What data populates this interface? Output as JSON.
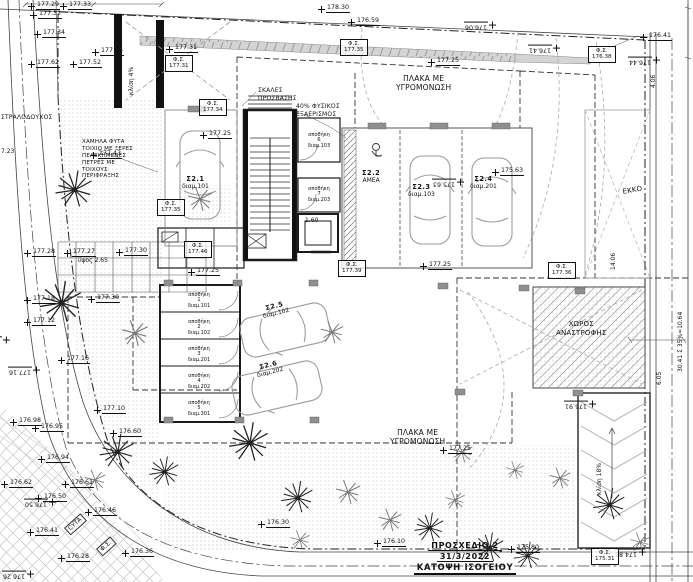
{
  "drawing": {
    "type": "site-plan",
    "colors": {
      "ink": "#111111",
      "road_gray": "#444444",
      "hatch_gray": "#999999",
      "sidewalk_fill": "#d4d4d4",
      "column_fill": "#8f8f8f",
      "paper": "#ffffff"
    }
  },
  "title_block": {
    "line1": "ΠΡΟΣΧΕΔΙΟ 2",
    "line2": "31/3/2022",
    "line3": "ΚΑΤΟΨΗ ΙΣΟΓΕΙΟΥ"
  },
  "symbols": {
    "street_light_label": "Φ.Σ.",
    "benchmark_icon": "survey-cross-icon",
    "tree_icon": "tree-icon",
    "bush_icon": "bush-icon",
    "car_icon": "car-icon",
    "wheelchair_icon": "wheelchair-icon"
  },
  "annotations": [
    {
      "x": 396,
      "y": 74,
      "fs": 7.5,
      "cls": "center",
      "lines": [
        "ΠΛΑΚΑ ΜΕ",
        "ΥΓΡΟΜΟΝΩΣΗ"
      ]
    },
    {
      "x": 390,
      "y": 428,
      "fs": 7.5,
      "cls": "center",
      "lines": [
        "ΠΛΑΚΑ ΜΕ",
        "ΥΓΡΟΜΟΝΩΣΗ"
      ]
    },
    {
      "x": 556,
      "y": 320,
      "fs": 7,
      "cls": "center",
      "lines": [
        "ΧΩΡΟΣ",
        "ΑΝΑΣΤΡΟΦΗΣ"
      ]
    },
    {
      "x": 622,
      "y": 188,
      "fs": 7,
      "rot": -10,
      "lines": [
        "ΕΚΚΟ"
      ]
    },
    {
      "x": 258,
      "y": 87,
      "fs": 6,
      "lines": [
        "ΣΚΑΛΕΣ",
        "ΠΡΟΣΒΑΣΗΣ"
      ]
    },
    {
      "x": 296,
      "y": 103,
      "fs": 6,
      "lines": [
        "40% ΦΥΣΙΚΟΣ",
        "ΕΞΑΕΡΙΣΜΟΣ"
      ]
    },
    {
      "x": 82,
      "y": 139,
      "fs": 5.5,
      "lines": [
        "ΧΑΜΗΛΑ ΦΥΤΑ",
        "ΤΟΙΧΙΟ ΜΕ ΞΕΡΕΣ",
        "ΠΕΛΕΚΗΜΕΝΕΣ",
        "ΠΕΤΡΕΣ ΜΕ",
        "ΤΟΙΧΟΥΣ",
        "ΠΕΡΙΦΡΑΞΗΣ"
      ]
    },
    {
      "x": 1,
      "y": 114,
      "fs": 6,
      "lines": [
        "ΣΤΡΑΛΟΔΟΥΧΟΣ"
      ]
    },
    {
      "x": 64,
      "y": 528,
      "fs": 6,
      "rot": -42,
      "cls": "box",
      "lines": [
        "CYTA"
      ]
    },
    {
      "x": 96,
      "y": 549,
      "fs": 6,
      "rot": -42,
      "cls": "box",
      "lines": [
        "Φ.Σ."
      ]
    }
  ],
  "spot_levels": [
    {
      "v": "177.29",
      "x": 28,
      "y": 2
    },
    {
      "v": "177.33",
      "x": 60,
      "y": 2
    },
    {
      "v": "177.32",
      "x": 30,
      "y": 11
    },
    {
      "v": "177.34",
      "x": 34,
      "y": 30
    },
    {
      "v": "177.62",
      "x": 28,
      "y": 60
    },
    {
      "v": "177.52",
      "x": 70,
      "y": 60
    },
    {
      "v": "177.65",
      "x": 92,
      "y": 48
    },
    {
      "v": "177.31",
      "x": 166,
      "y": 45
    },
    {
      "v": "178.30",
      "x": 318,
      "y": 5
    },
    {
      "v": "176.59",
      "x": 348,
      "y": 18
    },
    {
      "v": "177.25",
      "x": 428,
      "y": 58
    },
    {
      "v": "176.06",
      "x": 496,
      "y": 13,
      "r": 180
    },
    {
      "v": "176.41",
      "x": 560,
      "y": 36,
      "r": 180
    },
    {
      "v": "176.41",
      "x": 640,
      "y": 33
    },
    {
      "v": "176.44",
      "x": 660,
      "y": 48,
      "r": 180
    },
    {
      "v": "177.25",
      "x": 200,
      "y": 131
    },
    {
      "v": "175.63",
      "x": 492,
      "y": 168
    },
    {
      "v": "175.63",
      "x": 464,
      "y": 170,
      "r": 180
    },
    {
      "v": "177.25",
      "x": 420,
      "y": 262
    },
    {
      "v": "177.25",
      "x": 188,
      "y": 268
    },
    {
      "v": "177.28",
      "x": 24,
      "y": 249
    },
    {
      "v": "177.27",
      "x": 64,
      "y": 249
    },
    {
      "v": "177.30",
      "x": 116,
      "y": 248
    },
    {
      "v": "177.18",
      "x": 24,
      "y": 296
    },
    {
      "v": "177.30",
      "x": 88,
      "y": 295
    },
    {
      "v": "177.12",
      "x": 24,
      "y": 318
    },
    {
      "v": "177.00",
      "x": 10,
      "y": 328,
      "r": 182
    },
    {
      "v": "177.16",
      "x": 58,
      "y": 356
    },
    {
      "v": "177.16",
      "x": 40,
      "y": 358,
      "r": 180
    },
    {
      "v": "177.43",
      "x": 90,
      "y": 151
    },
    {
      "v": "176.98",
      "x": 10,
      "y": 418
    },
    {
      "v": "176.95",
      "x": 32,
      "y": 424
    },
    {
      "v": "177.10",
      "x": 94,
      "y": 406
    },
    {
      "v": "176.60",
      "x": 110,
      "y": 429
    },
    {
      "v": "176.94",
      "x": 38,
      "y": 455
    },
    {
      "v": "176.62",
      "x": 1,
      "y": 480
    },
    {
      "v": "176.61",
      "x": 62,
      "y": 480
    },
    {
      "v": "176.50",
      "x": 35,
      "y": 494
    },
    {
      "v": "176.50",
      "x": 56,
      "y": 490,
      "r": 180
    },
    {
      "v": "176.46",
      "x": 85,
      "y": 508
    },
    {
      "v": "176.41",
      "x": 27,
      "y": 528
    },
    {
      "v": "176.28",
      "x": 58,
      "y": 554
    },
    {
      "v": "176.26",
      "x": 34,
      "y": 562,
      "r": 180
    },
    {
      "v": "176.36",
      "x": 122,
      "y": 549
    },
    {
      "v": "176.30",
      "x": 258,
      "y": 520
    },
    {
      "v": "176.10",
      "x": 374,
      "y": 539
    },
    {
      "v": "175.80",
      "x": 508,
      "y": 545
    },
    {
      "v": "177.25",
      "x": 440,
      "y": 446
    },
    {
      "v": "175.91",
      "x": 596,
      "y": 392,
      "r": 180
    },
    {
      "v": "174.85",
      "x": 646,
      "y": 540,
      "r": 180
    }
  ],
  "street_lights": [
    {
      "x": 165,
      "y": 55,
      "v": "177.31"
    },
    {
      "x": 199,
      "y": 99,
      "v": "177.34"
    },
    {
      "x": 340,
      "y": 39,
      "v": "177.35"
    },
    {
      "x": 588,
      "y": 46,
      "v": "176.38"
    },
    {
      "x": 157,
      "y": 199,
      "v": "177.35"
    },
    {
      "x": 184,
      "y": 241,
      "v": "177.46"
    },
    {
      "x": 338,
      "y": 260,
      "v": "177.39"
    },
    {
      "x": 548,
      "y": 262,
      "v": "177.36"
    },
    {
      "x": 591,
      "y": 548,
      "v": "175.31"
    }
  ],
  "dimensions": [
    {
      "v": "4.06",
      "x": 651,
      "y": 88,
      "r": -90
    },
    {
      "v": "14.06",
      "x": 611,
      "y": 270,
      "r": -90
    },
    {
      "v": "6.05",
      "x": 657,
      "y": 385,
      "r": -90
    },
    {
      "v": "30.41 Σ 35%=10.64",
      "x": 678,
      "y": 372,
      "r": -90
    },
    {
      "v": "1.60",
      "x": 305,
      "y": 218
    },
    {
      "v": "ύψος 2.65",
      "x": 78,
      "y": 258
    },
    {
      "v": "κλίση 18%",
      "x": 597,
      "y": 495,
      "r": -90
    },
    {
      "v": "κλίση 4%",
      "x": 129,
      "y": 95,
      "r": -90
    },
    {
      "v": "7.23",
      "x": 1,
      "y": 149
    }
  ],
  "parking_spaces": [
    {
      "code": "Σ2.1",
      "apt": "διαμ.101",
      "x": 182,
      "y": 176
    },
    {
      "code": "Σ2.2",
      "apt": "ΑΜΕΑ",
      "x": 362,
      "y": 170
    },
    {
      "code": "Σ2.3",
      "apt": "διαμ.103",
      "x": 408,
      "y": 184
    },
    {
      "code": "Σ2.4",
      "apt": "διαμ.201",
      "x": 470,
      "y": 176
    },
    {
      "code": "Σ2.5",
      "apt": "διαμ.102",
      "x": 262,
      "y": 303,
      "rot": -14
    },
    {
      "code": "Σ2.6",
      "apt": "διαμ.202",
      "x": 256,
      "y": 362,
      "rot": -14
    }
  ],
  "storage_rooms": [
    {
      "x": 163,
      "y": 289,
      "w": 72,
      "h": 24,
      "lines": [
        "αποθήκη",
        "1",
        "διαμ.101"
      ]
    },
    {
      "x": 163,
      "y": 316,
      "w": 72,
      "h": 24,
      "lines": [
        "αποθήκη",
        "2",
        "διαμ.102"
      ]
    },
    {
      "x": 163,
      "y": 343,
      "w": 72,
      "h": 24,
      "lines": [
        "αποθήκη",
        "3",
        "διαμ.201"
      ]
    },
    {
      "x": 163,
      "y": 370,
      "w": 72,
      "h": 24,
      "lines": [
        "αποθήκη",
        "4",
        "διαμ.202"
      ]
    },
    {
      "x": 163,
      "y": 397,
      "w": 72,
      "h": 24,
      "lines": [
        "αποθήκη",
        "5",
        "διαμ.301"
      ]
    },
    {
      "x": 299,
      "y": 122,
      "w": 40,
      "h": 38,
      "lines": [
        "αποθήκη",
        "6",
        "διαμ.103"
      ]
    },
    {
      "x": 299,
      "y": 180,
      "w": 40,
      "h": 30,
      "lines": [
        "αποθήκη",
        "7",
        "διαμ.203"
      ]
    }
  ]
}
